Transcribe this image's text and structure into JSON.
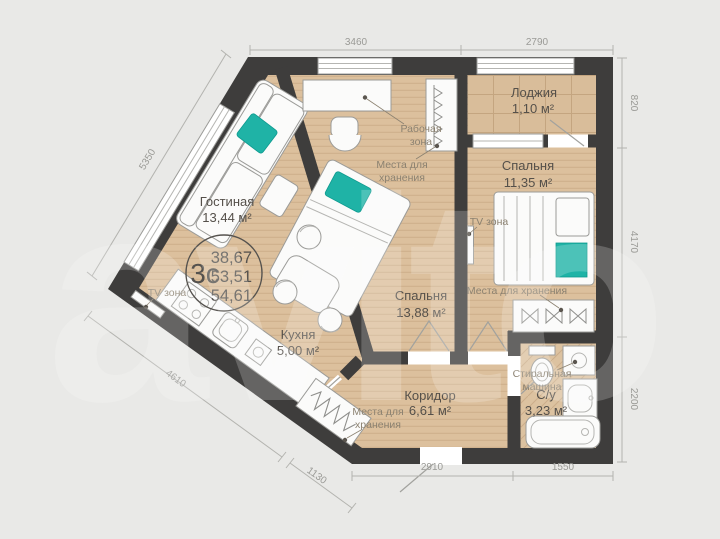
{
  "watermark": "avito",
  "summary": {
    "type": "3с",
    "areas": [
      "38,67",
      "53,51",
      "54,61"
    ]
  },
  "rooms": {
    "living": {
      "name": "Гостиная",
      "area": "13,44 м²"
    },
    "kitchen": {
      "name": "Кухня",
      "area": "5,00 м²"
    },
    "bedroom1": {
      "name": "Спальня",
      "area": "13,88 м²"
    },
    "bedroom2": {
      "name": "Спальня",
      "area": "11,35 м²"
    },
    "loggia": {
      "name": "Лоджия",
      "area": "1,10 м²"
    },
    "hallway": {
      "name": "Коридор",
      "area": "6,61 м²"
    },
    "bathroom": {
      "name": "С/у",
      "area": "3,23 м²"
    }
  },
  "callouts": {
    "work_zone": [
      "Рабочая",
      "зона"
    ],
    "storage": [
      "Места для",
      "хранения"
    ],
    "storage_inline": "Места для хранения",
    "tv_zone": "TV зона",
    "washer": [
      "Стиральная",
      "машина"
    ]
  },
  "dimensions": {
    "top_living": "3460",
    "top_loggia": "2790",
    "right_loggia": "820",
    "right_bedroom": "4170",
    "right_bathroom": "2200",
    "bottom_bathroom": "1550",
    "bottom_hallway": "2910",
    "diag_closet": "1130",
    "diag_kitchen": "4610",
    "diag_living": "5350"
  },
  "colors": {
    "wall": "#3e3d3c",
    "floor": "#dcc09d",
    "accent_teal": "#1fb3a6",
    "background": "#e9e9e7"
  }
}
